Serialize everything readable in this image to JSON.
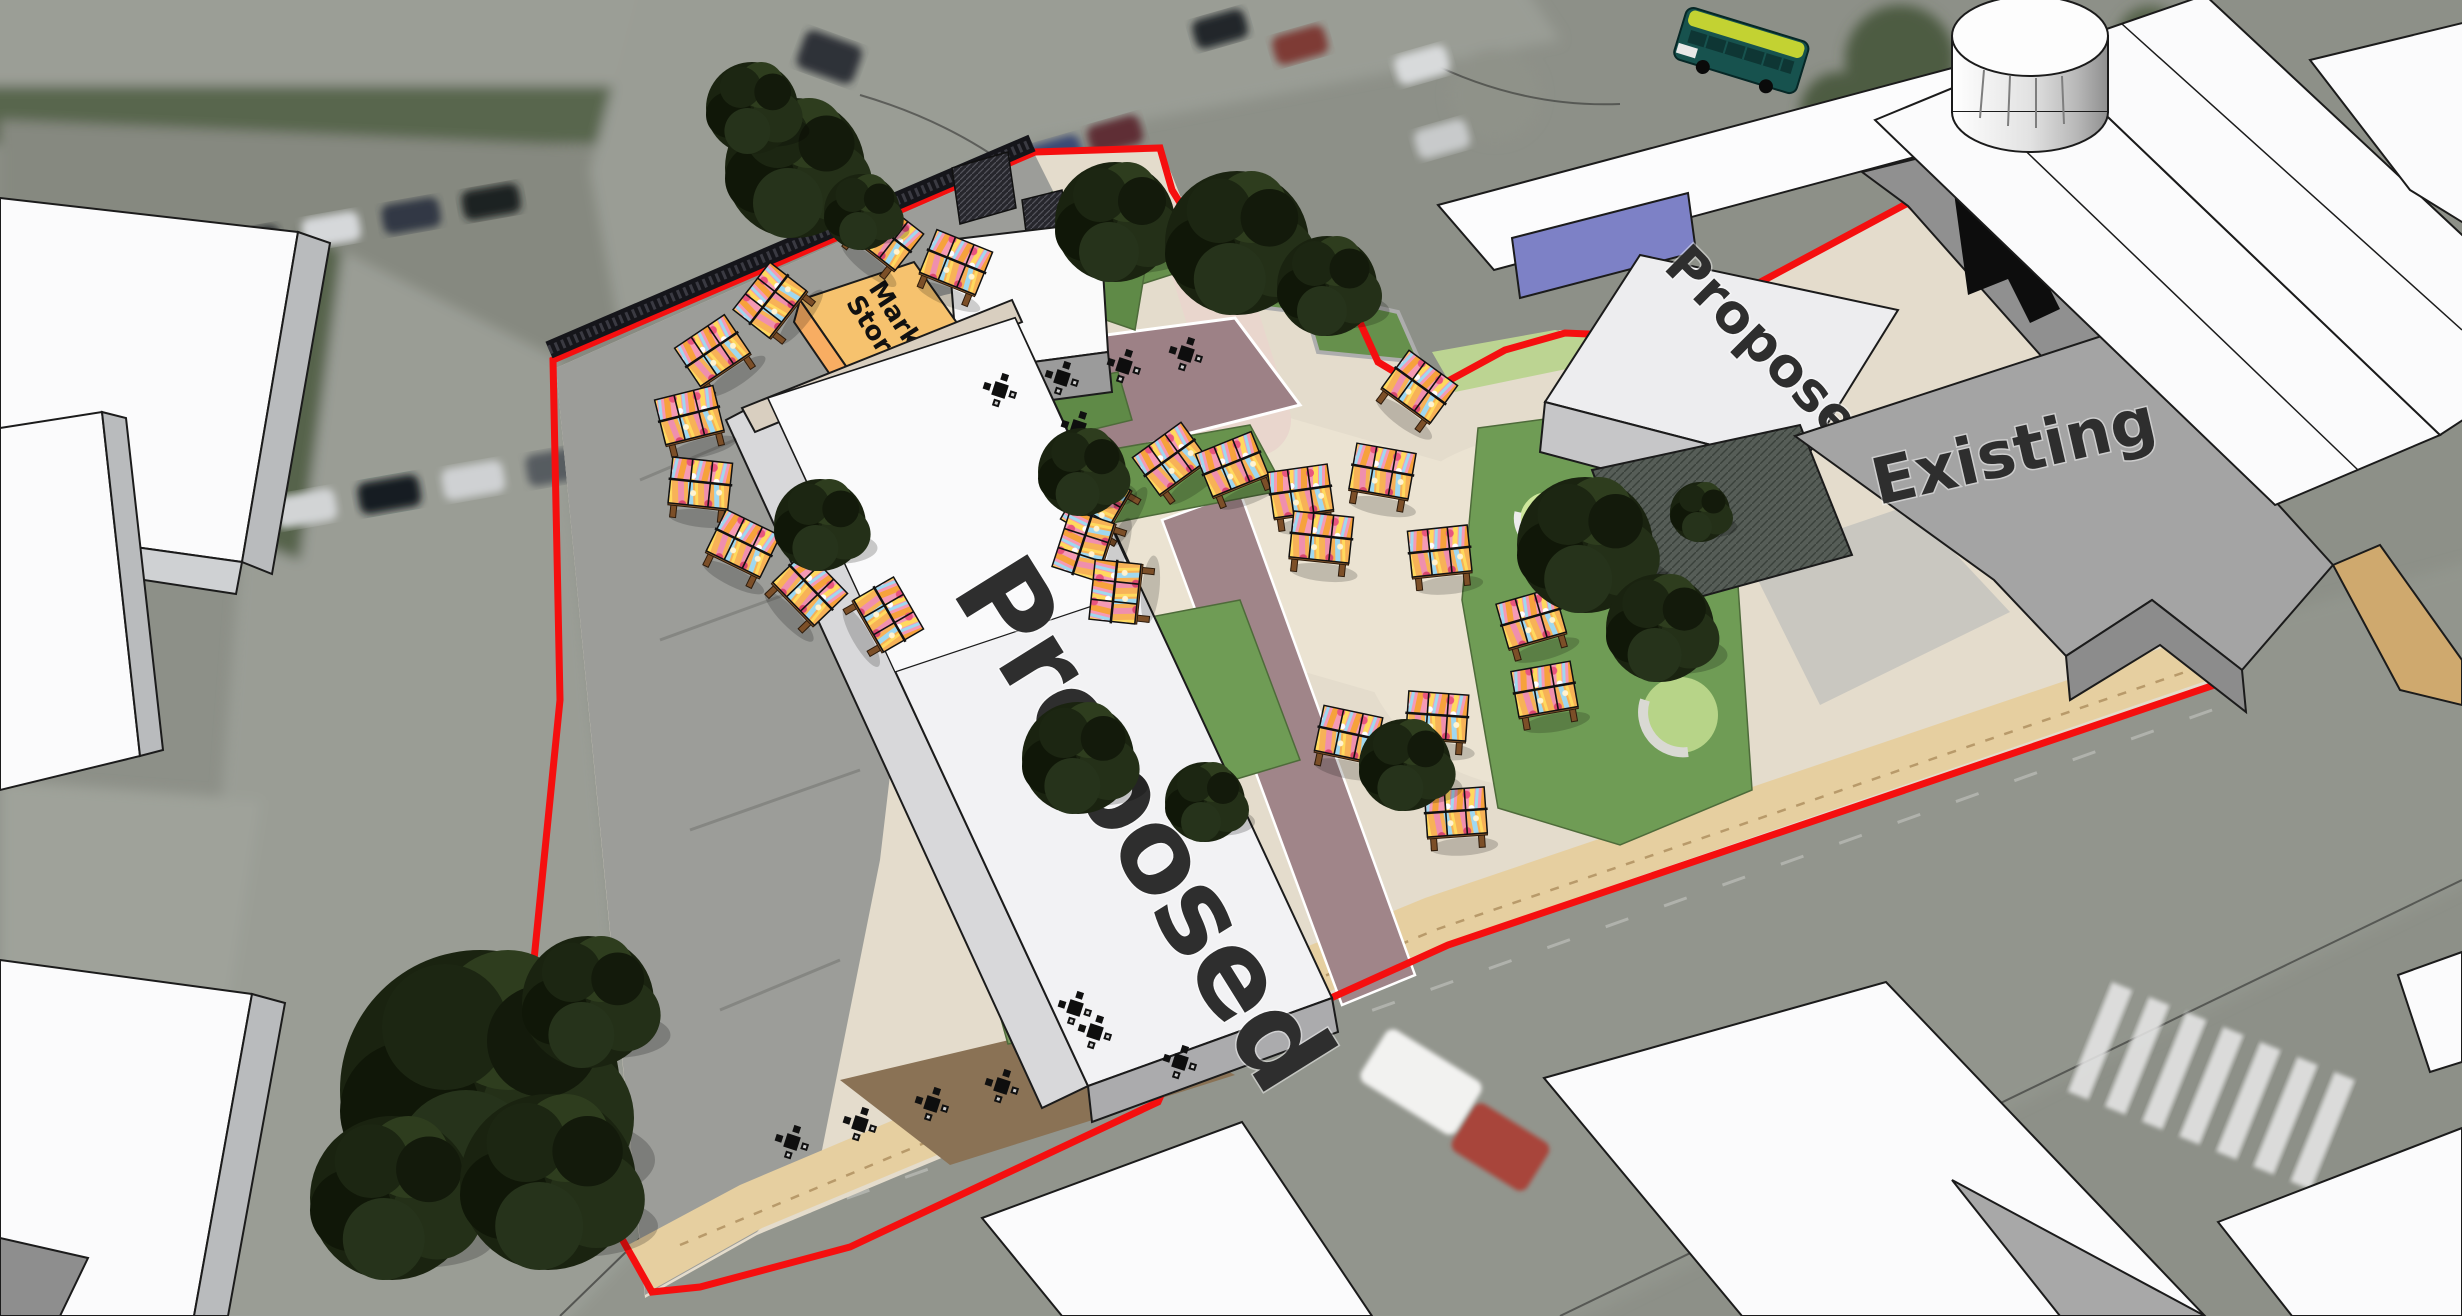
{
  "scene_labels": {
    "market_storage_line1": "Market",
    "market_storage_line2": "Storage",
    "proposed_west": "Proposed",
    "proposed_northeast": "Proposed",
    "existing": "Existing"
  },
  "colors": {
    "site_boundary_red": "#F50F0F",
    "market_storage_orange": "#F6C26E",
    "proposed_roof_white": "#F2F2F4",
    "existing_roof_grey": "#A4A4A4",
    "stall_canopy_pink": "#F59AB5",
    "stall_canopy_orange": "#F6A23C",
    "stall_canopy_yellow": "#FFD95E",
    "stall_canopy_blue": "#9FD8F0",
    "stall_frame_brown": "#7C4F28",
    "lawn_green": "#6F9C55",
    "paving_cream": "#E4DCCC",
    "terrace_mauve": "#9D8186",
    "frontage_sand": "#E6CFA0",
    "bus_body_teal": "#17524E",
    "bus_roof_lime": "#C3D232"
  },
  "scene_objects": {
    "market_stall_count": 25,
    "cafe_table_count": 12,
    "tree_count": 18,
    "vehicle_names": [
      "bus",
      "red-car",
      "white-van",
      "parked-cars"
    ]
  }
}
